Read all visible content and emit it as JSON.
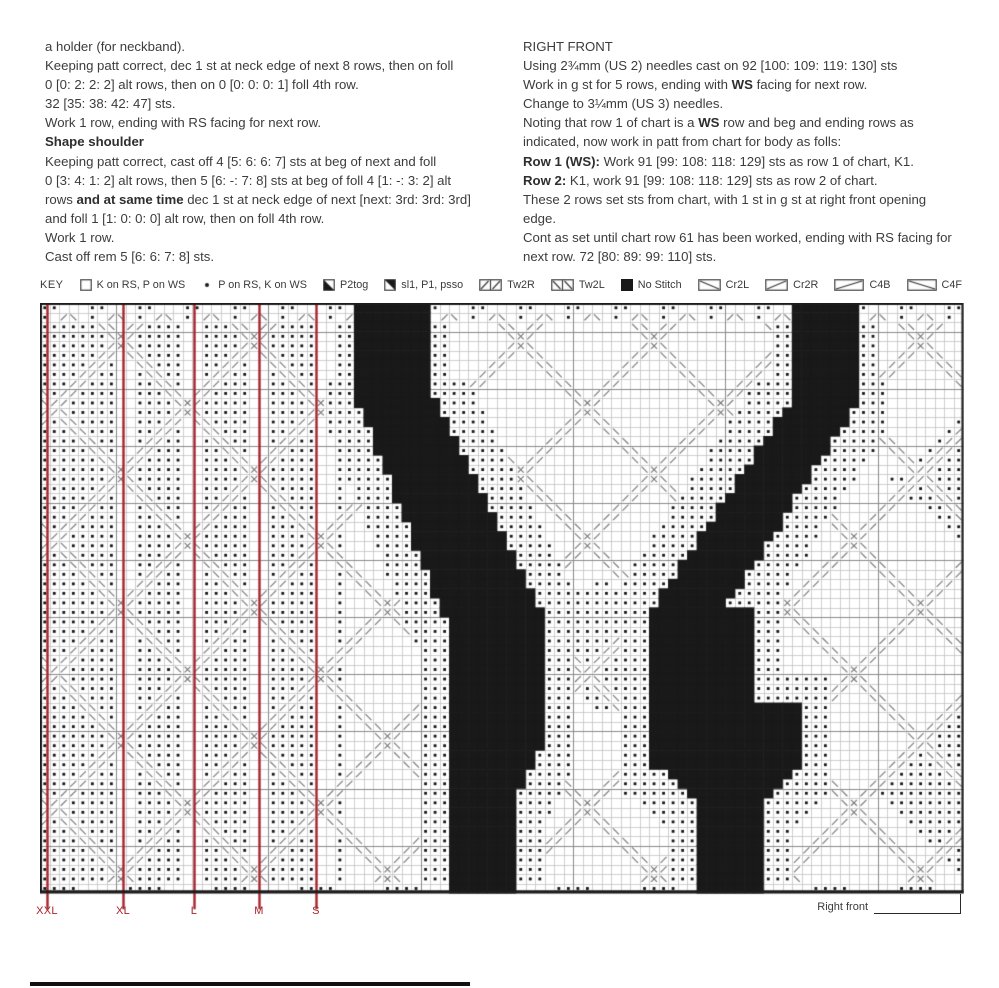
{
  "page_bg": "#ffffff",
  "left_column": {
    "lines": [
      [
        {
          "t": "a holder (for neckband)."
        }
      ],
      [
        {
          "t": "Keeping patt correct, dec 1 st at neck edge of next 8 rows, then on foll"
        }
      ],
      [
        {
          "t": "0 [0: 2: 2: 2] alt rows, then on 0 [0: 0: 0: 1] foll 4th row."
        }
      ],
      [
        {
          "t": "32 [35: 38: 42: 47] sts."
        }
      ],
      [
        {
          "t": "Work 1 row, ending with RS facing for next row."
        }
      ],
      [
        {
          "t": "Shape shoulder",
          "b": true
        }
      ],
      [
        {
          "t": "Keeping patt correct, cast off 4 [5: 6: 6: 7] sts at beg of next and foll"
        }
      ],
      [
        {
          "t": "0 [3: 4: 1: 2] alt rows, then 5 [6: -: 7: 8] sts at beg of foll 4 [1: -: 3: 2] alt"
        }
      ],
      [
        {
          "t": "rows "
        },
        {
          "t": "and at same time",
          "b": true
        },
        {
          "t": " dec 1 st at neck edge of next [next: 3rd: 3rd: 3rd]"
        }
      ],
      [
        {
          "t": "and foll 1 [1: 0: 0: 0] alt row, then on foll 4th row."
        }
      ],
      [
        {
          "t": "Work 1 row."
        }
      ],
      [
        {
          "t": "Cast off rem 5 [6: 6: 7: 8] sts."
        }
      ]
    ]
  },
  "right_column": {
    "lines": [
      [
        {
          "t": "RIGHT FRONT"
        }
      ],
      [
        {
          "t": "Using 2¾mm (US 2) needles cast on 92 [100: 109: 119: 130] sts"
        }
      ],
      [
        {
          "t": "Work in g st for 5 rows, ending with "
        },
        {
          "t": "WS",
          "b": true
        },
        {
          "t": " facing for next row."
        }
      ],
      [
        {
          "t": "Change to 3¼mm (US 3) needles."
        }
      ],
      [
        {
          "t": "Noting that row 1 of chart is a "
        },
        {
          "t": "WS",
          "b": true
        },
        {
          "t": " row and beg and ending rows as"
        }
      ],
      [
        {
          "t": "indicated, now work in patt from chart for body as folls:"
        }
      ],
      [
        {
          "t": "Row 1 (WS):",
          "b": true
        },
        {
          "t": " Work 91 [99: 108: 118: 129] sts as row 1 of chart, K1."
        }
      ],
      [
        {
          "t": "Row 2:",
          "b": true
        },
        {
          "t": " K1, work 91 [99: 108: 118: 129] sts as row 2 of chart."
        }
      ],
      [
        {
          "t": "These 2 rows set sts from chart, with 1 st in g st at right front opening"
        }
      ],
      [
        {
          "t": "edge."
        }
      ],
      [
        {
          "t": "Cont as set until chart row 61 has been worked, ending with RS facing for"
        }
      ],
      [
        {
          "t": "next row. 72 [80: 89: 99: 110] sts."
        }
      ]
    ]
  },
  "key": {
    "label": "KEY",
    "items": [
      {
        "icon": "square-empty-icon",
        "label": "K on RS, P on WS"
      },
      {
        "icon": "dot-icon",
        "label": "P on RS, K on WS"
      },
      {
        "icon": "p2tog-icon",
        "label": "P2tog"
      },
      {
        "icon": "psso-icon",
        "label": "sl1, P1, psso"
      },
      {
        "icon": "tw2r-icon",
        "label": "Tw2R"
      },
      {
        "icon": "tw2l-icon",
        "label": "Tw2L"
      },
      {
        "icon": "no-stitch-icon",
        "label": "No Stitch"
      },
      {
        "icon": "cr2l-icon",
        "label": "Cr2L"
      },
      {
        "icon": "cr2r-icon",
        "label": "Cr2R"
      },
      {
        "icon": "c4b-icon",
        "label": "C4B"
      },
      {
        "icon": "c4f-icon",
        "label": "C4F"
      }
    ]
  },
  "chart_data": {
    "type": "knitting-chart",
    "title": "Right front body chart",
    "rows_worked": 61,
    "cols": 97,
    "rows": 62,
    "cell": 9.52,
    "annotation_label": "Right front",
    "size_lines": [
      {
        "x": 7,
        "label": "XXL"
      },
      {
        "x": 83,
        "label": "XL"
      },
      {
        "x": 154,
        "label": "L"
      },
      {
        "x": 219,
        "label": "M"
      },
      {
        "x": 276,
        "label": "S"
      }
    ],
    "colors": {
      "grid": "#c3c3c3",
      "major": "#8a8a8a",
      "border": "#1c1c1c",
      "black": "#191919",
      "dot": "#141414",
      "mark": "#757575",
      "size_line": "#a8232d"
    },
    "black_regions": [
      [
        [
          310,
          0
        ],
        [
          389,
          0
        ],
        [
          389,
          80
        ],
        [
          310,
          80
        ]
      ],
      [
        [
          310,
          80
        ],
        [
          389,
          80
        ],
        [
          505,
          318
        ],
        [
          405,
          318
        ]
      ],
      [
        [
          405,
          318
        ],
        [
          505,
          318
        ],
        [
          505,
          440
        ],
        [
          405,
          440
        ]
      ],
      [
        [
          405,
          440
        ],
        [
          505,
          440
        ],
        [
          477,
          492
        ],
        [
          477,
          590
        ],
        [
          405,
          590
        ]
      ],
      [
        [
          748,
          0
        ],
        [
          817,
          0
        ],
        [
          817,
          100
        ],
        [
          748,
          100
        ]
      ],
      [
        [
          748,
          100
        ],
        [
          817,
          100
        ],
        [
          688,
          302
        ],
        [
          613,
          302
        ]
      ],
      [
        [
          613,
          302
        ],
        [
          712,
          302
        ],
        [
          712,
          398
        ],
        [
          613,
          398
        ]
      ],
      [
        [
          613,
          398
        ],
        [
          758,
          398
        ],
        [
          758,
          462
        ],
        [
          613,
          462
        ]
      ],
      [
        [
          613,
          462
        ],
        [
          758,
          462
        ],
        [
          723,
          500
        ],
        [
          723,
          590
        ],
        [
          658,
          590
        ],
        [
          658,
          500
        ]
      ]
    ],
    "dot_regions": [
      [
        [
          560,
          272
        ],
        [
          650,
          342
        ],
        [
          560,
          412
        ],
        [
          470,
          342
        ]
      ],
      [
        [
          924,
          112
        ],
        [
          850,
          177
        ],
        [
          924,
          242
        ]
      ],
      [
        [
          924,
          382
        ],
        [
          828,
          477
        ],
        [
          924,
          572
        ]
      ]
    ],
    "left_panel": {
      "cols": 32,
      "gap_mod": 7,
      "gap_vals": [
        1,
        2
      ],
      "solid_cols": 4
    },
    "lattice": {
      "period": 14,
      "u_offset": 3,
      "v_offset": 10
    },
    "fringe_radius": 3,
    "fringe_radius_top": 2
  }
}
